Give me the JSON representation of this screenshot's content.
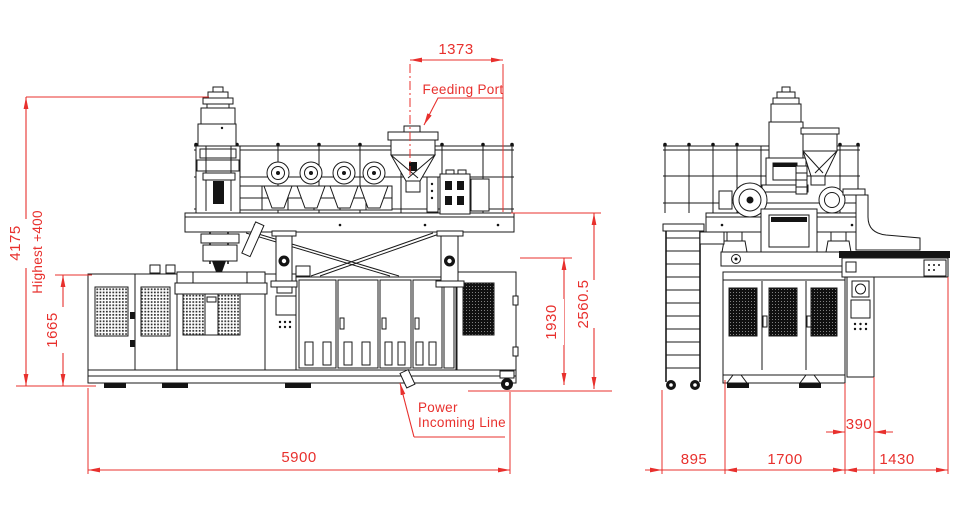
{
  "drawing": {
    "type": "engineering-dimension-drawing",
    "subject": "blow molding machine - front and side elevation views",
    "colors": {
      "dimension_accent": "#e8302d",
      "line": "#1a1a1a",
      "background": "#ffffff"
    },
    "front_view": {
      "dimensions": {
        "overall_height": "4175",
        "highest_note": "Highest +400",
        "cabinet_height": "1665",
        "feeding_port_offset": "1373",
        "body_height": "1930",
        "platform_height": "2560.5",
        "overall_length": "5900"
      },
      "labels": {
        "feeding_port": "Feeding Port",
        "power_line_1": "Power",
        "power_line_2": "Incoming Line"
      }
    },
    "side_view": {
      "dimensions": {
        "ladder_depth": "895",
        "machine_depth": "1700",
        "conveyor_extension": "1430",
        "panel_offset": "390"
      }
    }
  }
}
